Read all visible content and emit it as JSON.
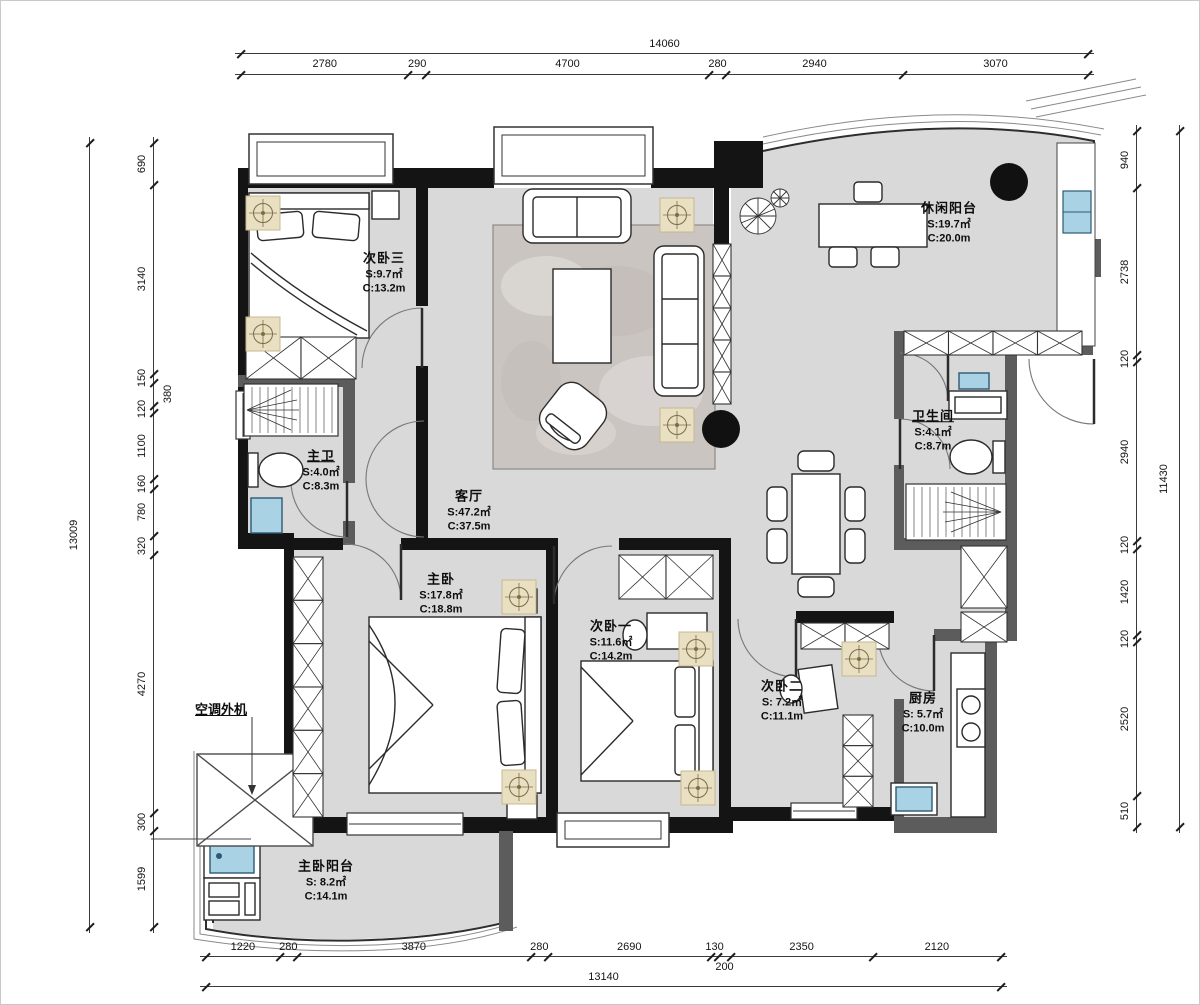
{
  "title": "apartment-floor-plan",
  "rooms": [
    {
      "id": "bedroom-3",
      "name": "次卧三",
      "s": "S:9.7㎡",
      "c": "C:13.2m",
      "underline": false
    },
    {
      "id": "leisure-balcony",
      "name": "休闲阳台",
      "s": "S:19.7㎡",
      "c": "C:20.0m",
      "underline": false
    },
    {
      "id": "master-bath",
      "name": "主卫",
      "s": "S:4.0㎡",
      "c": "C:8.3m",
      "underline": true
    },
    {
      "id": "bathroom",
      "name": "卫生间",
      "s": "S:4.1㎡",
      "c": "C:8.7m",
      "underline": true
    },
    {
      "id": "living-room",
      "name": "客厅",
      "s": "S:47.2㎡",
      "c": "C:37.5m",
      "underline": false
    },
    {
      "id": "master-bedroom",
      "name": "主卧",
      "s": "S:17.8㎡",
      "c": "C:18.8m",
      "underline": false
    },
    {
      "id": "bedroom-1",
      "name": "次卧一",
      "s": "S:11.6㎡",
      "c": "C:14.2m",
      "underline": false
    },
    {
      "id": "bedroom-2",
      "name": "次卧二",
      "s": "S: 7.2㎡",
      "c": "C:11.1m",
      "underline": false
    },
    {
      "id": "kitchen",
      "name": "厨房",
      "s": "S: 5.7㎡",
      "c": "C:10.0m",
      "underline": false
    },
    {
      "id": "master-balcony",
      "name": "主卧阳台",
      "s": "S: 8.2㎡",
      "c": "C:14.1m",
      "underline": false
    }
  ],
  "annotations": {
    "ac_unit": "空调外机"
  },
  "dims": {
    "top": {
      "total": "14060",
      "segments": [
        "2780",
        "290",
        "4700",
        "280",
        "2940",
        "3070"
      ]
    },
    "bottom": {
      "total": "13140",
      "segments": [
        "1220",
        "280",
        "3870",
        "280",
        "2690",
        "130",
        "200",
        "2350",
        "2120"
      ]
    },
    "left": {
      "total": "13009",
      "segments": [
        "690",
        "3140",
        "150",
        "380",
        "120",
        "1100",
        "160",
        "780",
        "320",
        "4270",
        "300",
        "1599"
      ]
    },
    "right": {
      "total": "11430",
      "segments": [
        "940",
        "2738",
        "120",
        "2940",
        "120",
        "1420",
        "120",
        "2520",
        "510"
      ]
    }
  },
  "colors": {
    "wall": "#141414",
    "partition": "#5c5c5c",
    "floor": "#d9d9d9",
    "rug": "#cbc5c1",
    "fixture_blue": "#a9d3e4",
    "lamp_tan": "#e9dfc2",
    "dim_text": "#141414"
  }
}
